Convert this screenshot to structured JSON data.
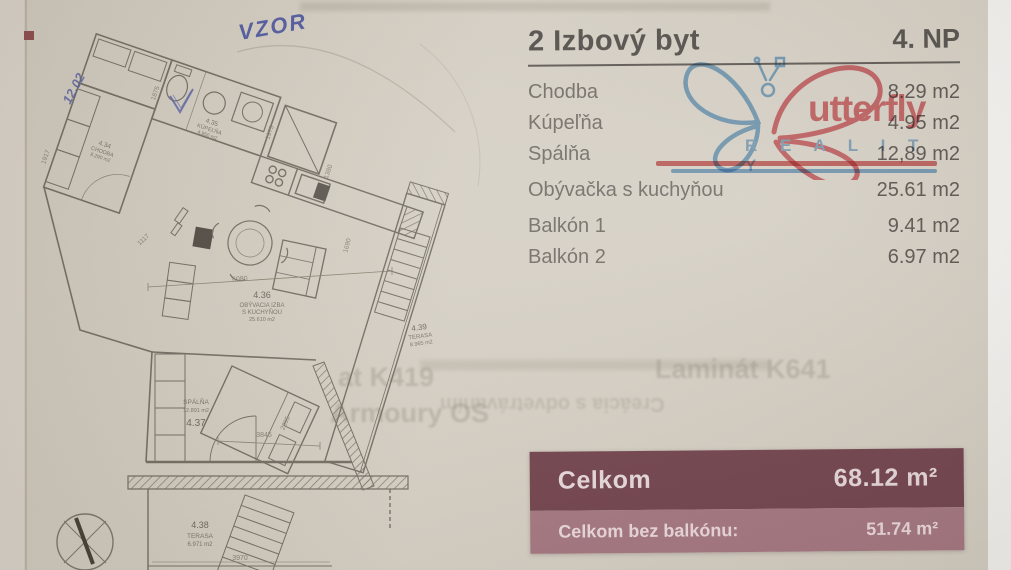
{
  "header": {
    "title": "2 Izbový byt",
    "floor": "4. NP"
  },
  "rooms": [
    {
      "label": "Chodba",
      "value": "8.29 m2"
    },
    {
      "label": "Kúpeľňa",
      "value": "4.95 m2"
    },
    {
      "label": "Spálňa",
      "value": "12,89 m2"
    },
    {
      "label": "Obývačka s kuchyňou",
      "value": "25.61 m2"
    },
    {
      "label": "Balkón 1",
      "value": "9.41 m2"
    },
    {
      "label": "Balkón 2",
      "value": "6.97 m2"
    }
  ],
  "logo": {
    "brand": "Butterfly Reality",
    "word": "utterfly",
    "sub": "R E A L I T Y",
    "blue": "#7db1dc",
    "red": "#e06b74"
  },
  "summary": {
    "total_label": "Celkom",
    "total_value": "68.12 m²",
    "net_label": "Celkom bez balkónu:",
    "net_value": "51.74 m²",
    "dark_bg": "#6d3a46",
    "light_bg": "#a4727e"
  },
  "floorplan": {
    "handwriting": {
      "vzor": "VZOR",
      "note": "12.02"
    },
    "rooms": {
      "chodba": {
        "num": "4.34",
        "name": "CHODBA",
        "area": "8.290 m2"
      },
      "kupelna": {
        "num": "4.35",
        "name": "KÚPEĽŇA",
        "area": "4.950 m2"
      },
      "obyvacka": {
        "num": "4.36",
        "name1": "OBÝVACIA IZBA",
        "name2": "S KUCHYŇOU",
        "area": "25.610 m2"
      },
      "spalna": {
        "num": "4.37",
        "name": "SPÁLŇA",
        "area": "12.891 m2"
      },
      "terasa1": {
        "num": "4.39",
        "name": "TERASA",
        "area": "8.965 m2"
      },
      "terasa2": {
        "num": "4.38",
        "name": "TERASA",
        "area": "6.971 m2"
      }
    },
    "dims": {
      "d1917": "1917",
      "d1875": "1875",
      "d1973": "1973",
      "d1380": "1380",
      "d1117": "1117",
      "d6080": "6080",
      "d1690": "1690",
      "d3845": "3845",
      "d2395": "2395",
      "d3970": "3970"
    }
  },
  "bleedthrough": {
    "frag1": "at K419",
    "frag2": "Laminát K641",
    "frag3": "Creácia s odvetrávaním",
    "frag4": "Armoury OS"
  }
}
